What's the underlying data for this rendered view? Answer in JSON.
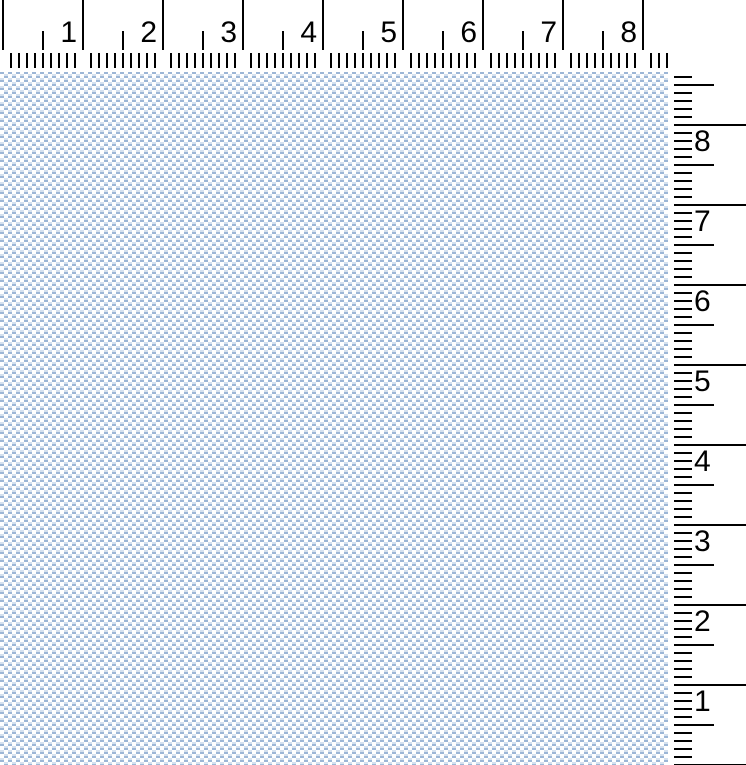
{
  "horizontal_ruler": {
    "unit_labels": [
      "1",
      "2",
      "3",
      "4",
      "5",
      "6",
      "7",
      "8"
    ],
    "origin_x_px": 2,
    "unit_spacing_px": 80,
    "minor_spacing_px": 8,
    "minor_count": 84,
    "length_px": 668,
    "height_px": 72
  },
  "vertical_ruler": {
    "unit_labels": [
      "8",
      "7",
      "6",
      "5",
      "4",
      "3",
      "2",
      "1"
    ],
    "minor_start_y_px": 76,
    "unit_spacing_px": 80,
    "minor_spacing_px": 8,
    "minor_count": 87,
    "width_px": 78
  },
  "canvas_pattern": {
    "dash_color": "#9cb6d6",
    "light_dash_color": "#d5e1ef",
    "background_color": "#ffffff",
    "tile_px": 8
  },
  "tick_color": "#000000"
}
